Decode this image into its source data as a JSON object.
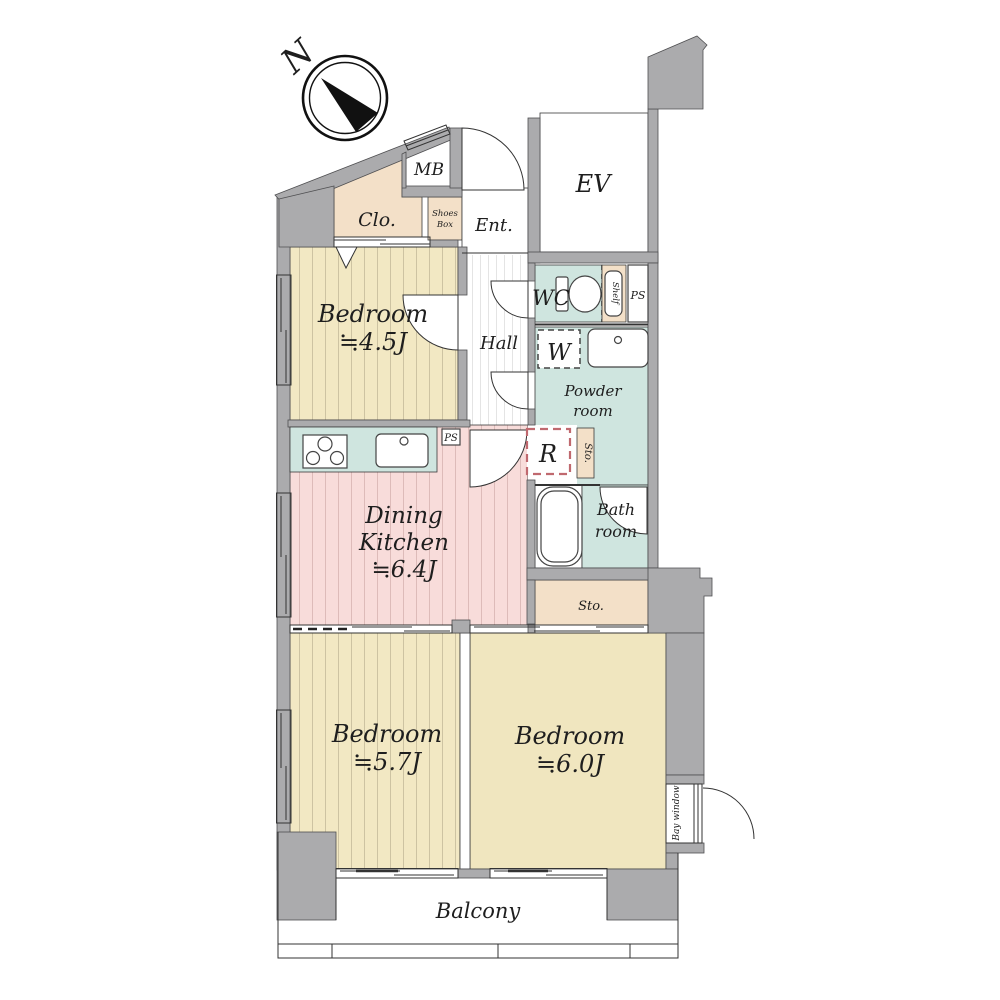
{
  "compass": {
    "north_label": "N"
  },
  "colors": {
    "wall_gray": "#ababad",
    "tan": "#f3e0c8",
    "teal": "#cfe5df",
    "bedroom_yellow": "#f2e8c3",
    "bedroom_plain": "#f0e6bf",
    "dk_pink": "#f8dcda",
    "line": "#333333",
    "refrigerator_dash": "#c0696f"
  },
  "rooms": {
    "closet": {
      "label": "Clo."
    },
    "meter_box": {
      "label": "MB"
    },
    "shoes_box": {
      "line1": "Shoes",
      "line2": "Box"
    },
    "entrance": {
      "label": "Ent."
    },
    "elevator": {
      "label": "EV"
    },
    "bedroom_45": {
      "label": "Bedroom",
      "area": "≒4.5J"
    },
    "hall": {
      "label": "Hall"
    },
    "wc": {
      "label": "WC"
    },
    "shelf": {
      "label": "Shelf"
    },
    "pipe_space_upper": {
      "label": "PS"
    },
    "washer": {
      "label": "W"
    },
    "powder_room": {
      "line1": "Powder",
      "line2": "room"
    },
    "pipe_space_kitchen": {
      "label": "PS"
    },
    "refrigerator": {
      "label": "R"
    },
    "storage_small": {
      "label": "Sto."
    },
    "dining_kitchen": {
      "line1": "Dining",
      "line2": "Kitchen",
      "area": "≒6.4J"
    },
    "bathroom": {
      "line1": "Bath",
      "line2": "room"
    },
    "storage": {
      "label": "Sto."
    },
    "bedroom_57": {
      "label": "Bedroom",
      "area": "≒5.7J"
    },
    "bedroom_60": {
      "label": "Bedroom",
      "area": "≒6.0J"
    },
    "bay_window": {
      "label": "Bay window"
    },
    "balcony": {
      "label": "Balcony"
    }
  }
}
